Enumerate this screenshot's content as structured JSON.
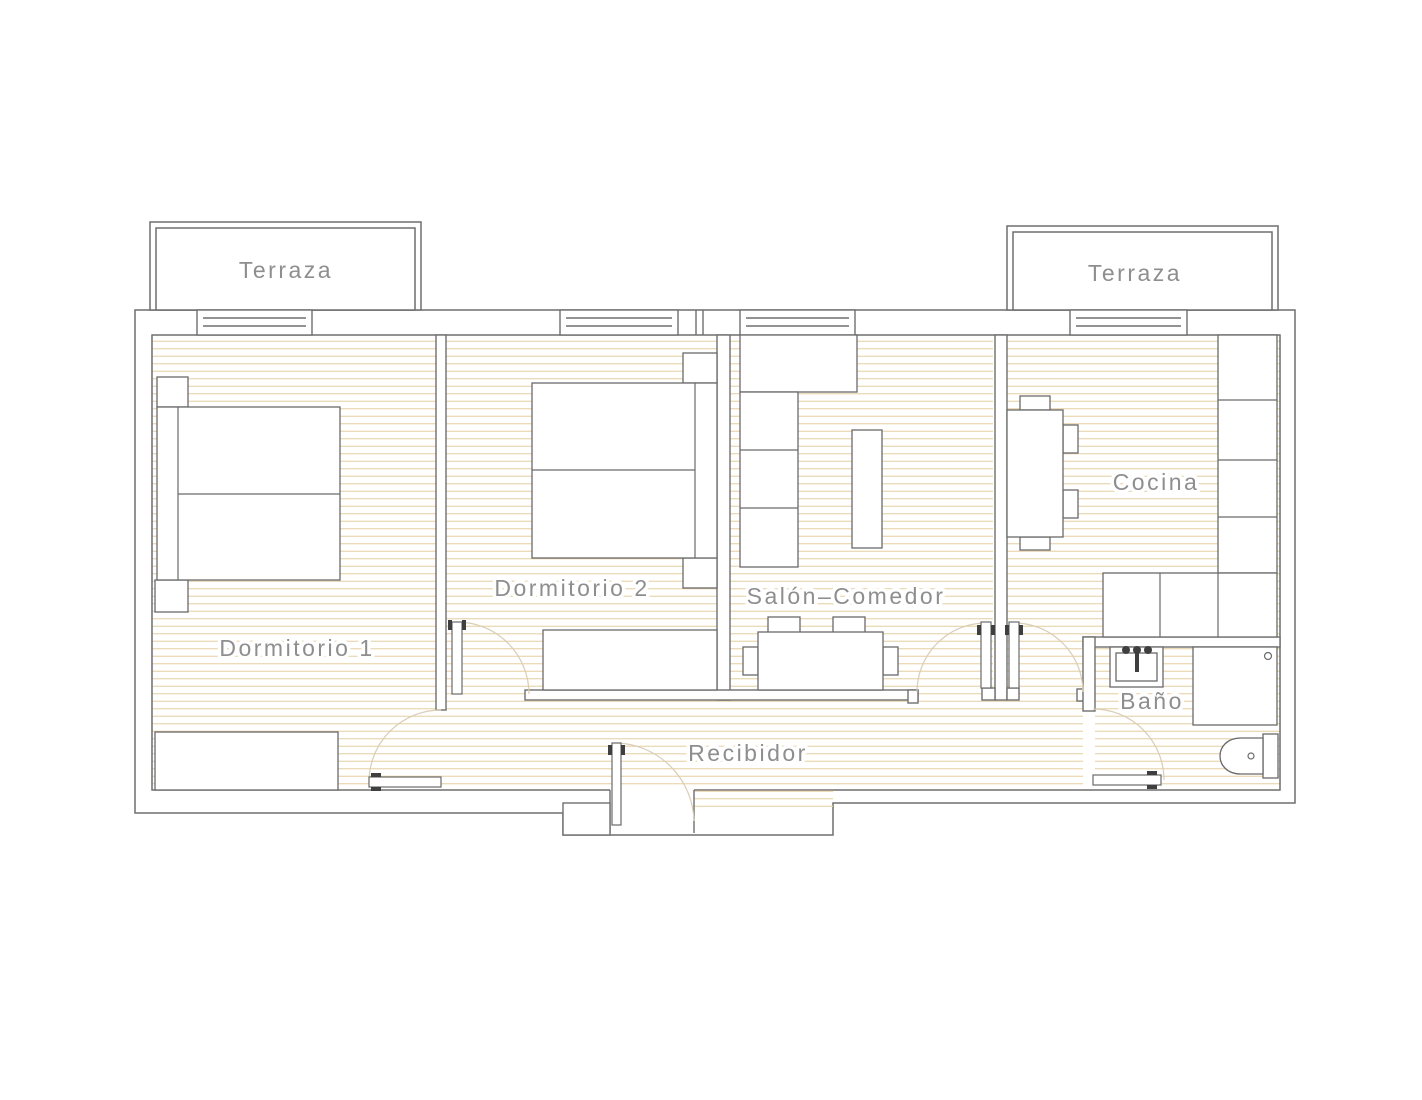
{
  "document": {
    "type": "architectural floor plan",
    "language": "es",
    "style": "CAD line drawing, horizontal tan floor hatching"
  },
  "colors": {
    "background": "#ffffff",
    "wall_line": "#6f6f6f",
    "furniture_line": "#6a6a6a",
    "floor_hatch": "#e7d2a8",
    "door_arc": "#d9cdb4",
    "label_text": "#8e8e8e",
    "door_mark": "#3f3f3f"
  },
  "labels": {
    "terraza_left": "Terraza",
    "terraza_right": "Terraza",
    "dormitorio_1": "Dormitorio 1",
    "dormitorio_2": "Dormitorio 2",
    "salon_comedor": "Salón–Comedor",
    "cocina": "Cocina",
    "bano": "Baño",
    "recibidor": "Recibidor"
  },
  "rooms": [
    {
      "name": "Terraza (izquierda)",
      "features": [
        "window to Dormitorio 1"
      ]
    },
    {
      "name": "Terraza (derecha)",
      "features": [
        "window to Cocina"
      ]
    },
    {
      "name": "Dormitorio 1",
      "features": [
        "double-bed",
        "nightstand x2",
        "wardrobe",
        "swing-door"
      ]
    },
    {
      "name": "Dormitorio 2",
      "features": [
        "double-bed",
        "nightstand x2",
        "closet",
        "swing-door",
        "window"
      ]
    },
    {
      "name": "Salón–Comedor",
      "features": [
        "sideboard",
        "sofa (3 modules)",
        "coffee-table",
        "dining-table",
        "chair x4",
        "swing-door",
        "window"
      ]
    },
    {
      "name": "Cocina",
      "features": [
        "table",
        "chair x4",
        "counter-run",
        "swing-door",
        "window"
      ]
    },
    {
      "name": "Baño",
      "features": [
        "washbasin",
        "shower",
        "toilet",
        "swing-door"
      ]
    },
    {
      "name": "Recibidor",
      "features": [
        "entrance-door"
      ]
    }
  ]
}
